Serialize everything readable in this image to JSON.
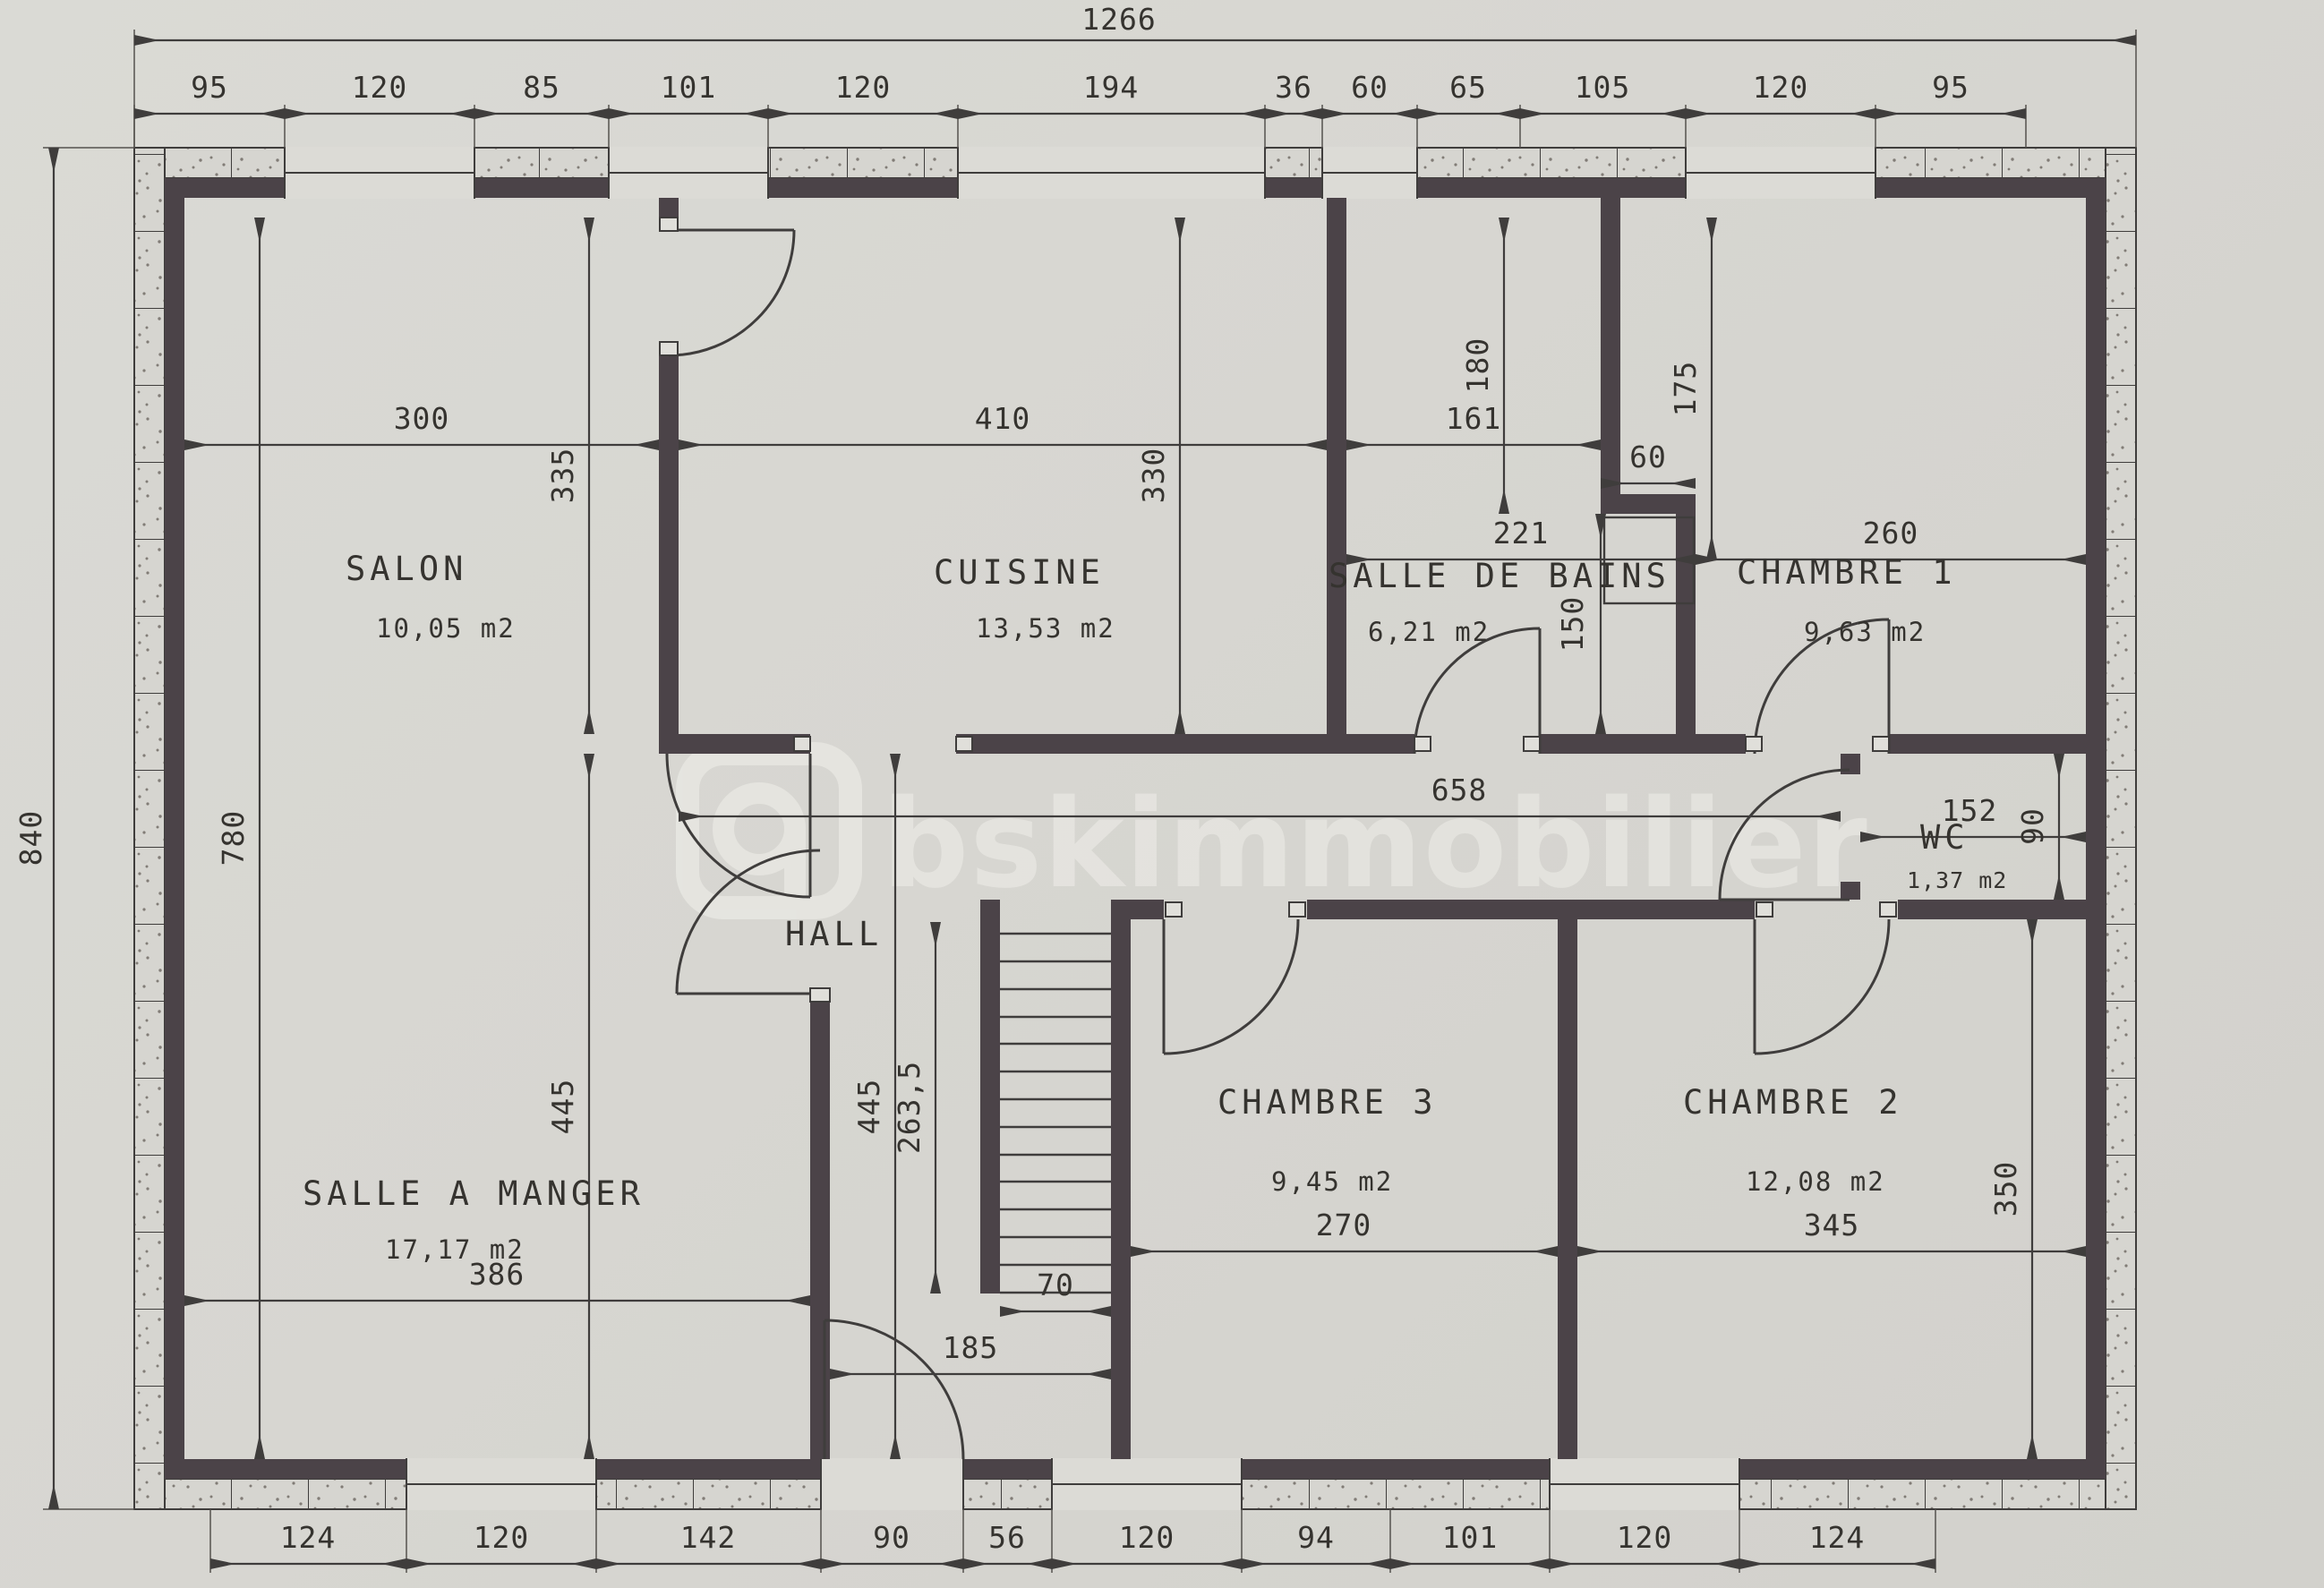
{
  "watermark": {
    "brand": "bskimmobilier"
  },
  "plan": {
    "overall": {
      "width": "1266",
      "height": "840"
    },
    "rooms": {
      "salon": {
        "name": "SALON",
        "area": "10,05 m2"
      },
      "cuisine": {
        "name": "CUISINE",
        "area": "13,53 m2"
      },
      "salle_de_bains": {
        "name": "SALLE DE BAINS",
        "area": "6,21 m2"
      },
      "chambre1": {
        "name": "CHAMBRE 1",
        "area": "9,63 m2"
      },
      "hall": {
        "name": "HALL"
      },
      "wc": {
        "name": "WC",
        "area": "1,37 m2"
      },
      "salle_a_manger": {
        "name": "SALLE A MANGER",
        "area": "17,17 m2"
      },
      "chambre3": {
        "name": "CHAMBRE 3",
        "area": "9,45 m2"
      },
      "chambre2": {
        "name": "CHAMBRE 2",
        "area": "12,08 m2"
      }
    },
    "dims": {
      "top": [
        "95",
        "120",
        "85",
        "101",
        "120",
        "194",
        "36",
        "60",
        "65",
        "105",
        "120",
        "95"
      ],
      "bottom": [
        "124",
        "120",
        "142",
        "90",
        "56",
        "120",
        "94",
        "101",
        "120",
        "124"
      ],
      "salon_width": "300",
      "cuisine_width": "410",
      "bains_width": "161",
      "bains_niche": "60",
      "bains_span": "221",
      "chambre1_width": "260",
      "salon_height": "335",
      "cuisine_height": "330",
      "left_height": "780",
      "bains_height_top": "180",
      "chambre1_height": "175",
      "bains_height_bottom": "150",
      "corridor_length": "658",
      "wc_width": "152",
      "wc_height": "90",
      "stair_length": "263,5",
      "hall_height_left": "445",
      "hall_height_right": "445",
      "salle_a_manger_width": "386",
      "stair_width": "70",
      "hall_width": "185",
      "chambre3_width": "270",
      "chambre2_width": "345",
      "chambre2_height": "350"
    }
  }
}
